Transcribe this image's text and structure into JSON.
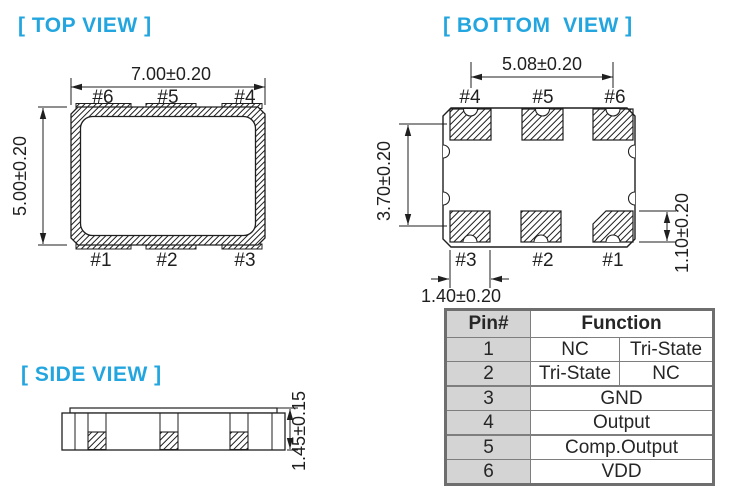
{
  "palette": {
    "accent_cyan": "#23a6df",
    "line_black": "#1f1f1f",
    "table_gray": "#d4d4d4",
    "table_border_gray": "#7e7e7e"
  },
  "views": {
    "top": {
      "label": "[ TOP VIEW ]",
      "dim_width": "7.00±0.20",
      "dim_height": "5.00±0.20",
      "pins_top": [
        "#6",
        "#5",
        "#4"
      ],
      "pins_bottom": [
        "#1",
        "#2",
        "#3"
      ]
    },
    "bottom": {
      "label": "[ BOTTOM  VIEW ]",
      "dim_pad_span": "5.08±0.20",
      "dim_row_pitch": "3.70±0.20",
      "dim_pad_height": "1.10±0.20",
      "dim_pad_width": "1.40±0.20",
      "pins_top": [
        "#4",
        "#5",
        "#6"
      ],
      "pins_bottom": [
        "#3",
        "#2",
        "#1"
      ]
    },
    "side": {
      "label": "[ SIDE VIEW ]",
      "dim_height": "1.45±0.15"
    }
  },
  "pin_table": {
    "headers": {
      "pin": "Pin#",
      "function": "Function"
    },
    "rows": [
      {
        "pin": "1",
        "left": "NC",
        "right": "Tri-State"
      },
      {
        "pin": "2",
        "left": "Tri-State",
        "right": "NC"
      },
      {
        "pin": "3",
        "function": "GND"
      },
      {
        "pin": "4",
        "function": "Output"
      },
      {
        "pin": "5",
        "function": "Comp.Output"
      },
      {
        "pin": "6",
        "function": "VDD"
      }
    ]
  }
}
